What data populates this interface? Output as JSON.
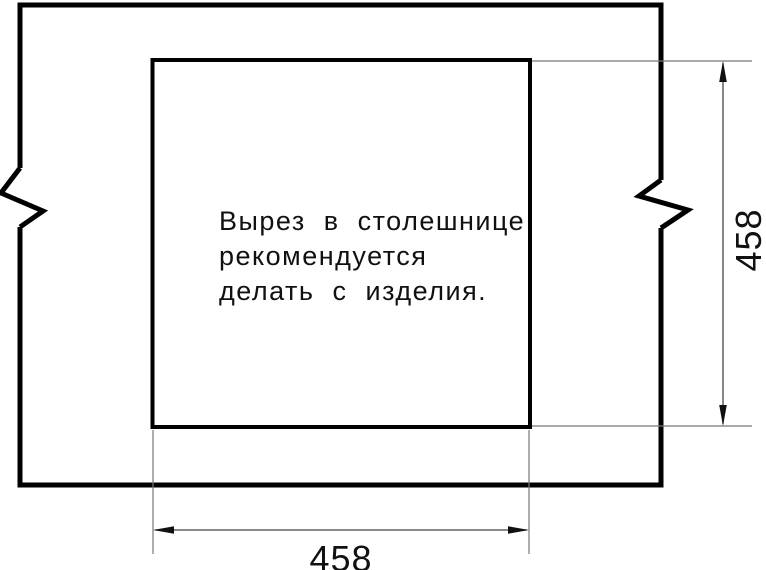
{
  "note": {
    "lines": [
      "Вырез в столешнице",
      "рекомендуется",
      "делать с изделия."
    ]
  },
  "dimensions": {
    "cutout_width_mm": "458",
    "cutout_height_mm": "458"
  },
  "colors": {
    "thick_line": "#000000",
    "thin_line": "#787878",
    "dimension_line": "#444444",
    "arrow": "#111111",
    "text": "#111111",
    "background": "#ffffff"
  }
}
